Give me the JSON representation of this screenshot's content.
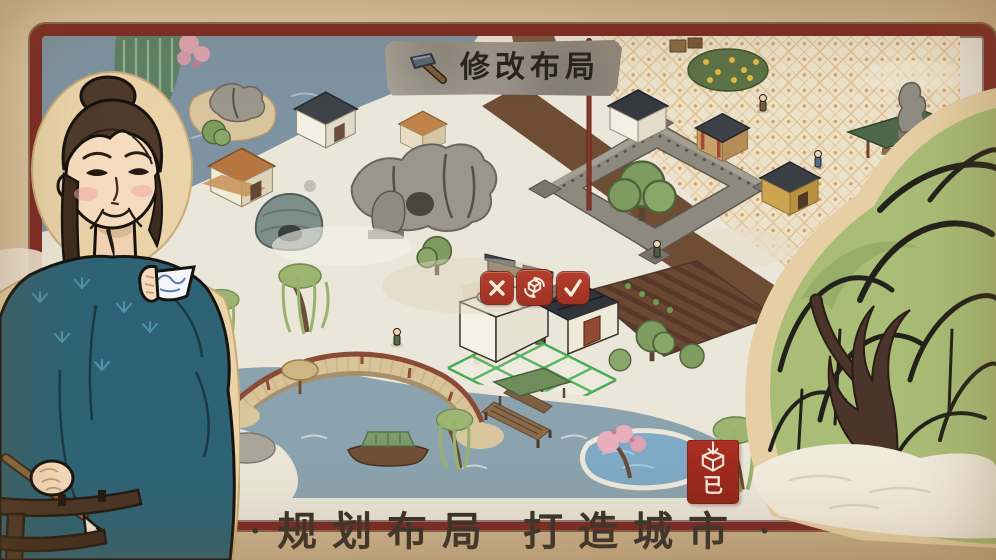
{
  "top_banner": {
    "icon": "hammer-icon",
    "label": "修改布局"
  },
  "edit_controls": {
    "cancel": {
      "icon": "cancel-icon"
    },
    "rotate": {
      "icon": "rotate-cube-icon"
    },
    "confirm": {
      "icon": "confirm-icon"
    }
  },
  "storage_button": {
    "icon": "store-box-icon",
    "label": "已"
  },
  "slogan": {
    "left_dot": "·",
    "phrase_1": "规划布局",
    "phrase_2": "打造城市",
    "right_dot": "·"
  },
  "scene": {
    "alt": "Isometric hand-painted snowy canal town: arched bridge over river, stone wall enclosure, tiled plaza, plowed field, and a white house being placed on a green grid"
  },
  "colors": {
    "parchment": "#d5bf9d",
    "frame_red": "#7c2a24",
    "button_red": "#ad392a",
    "plaque_stone": "#9b948a",
    "plaque_text": "#28231d",
    "storage_red": "#9e2b20",
    "grid_green": "#2fa23b",
    "slogan_text": "#3a332b",
    "robe_teal": "#2e6375",
    "willow_green": "#a9bd77",
    "water_blue": "#8ba3ae"
  }
}
